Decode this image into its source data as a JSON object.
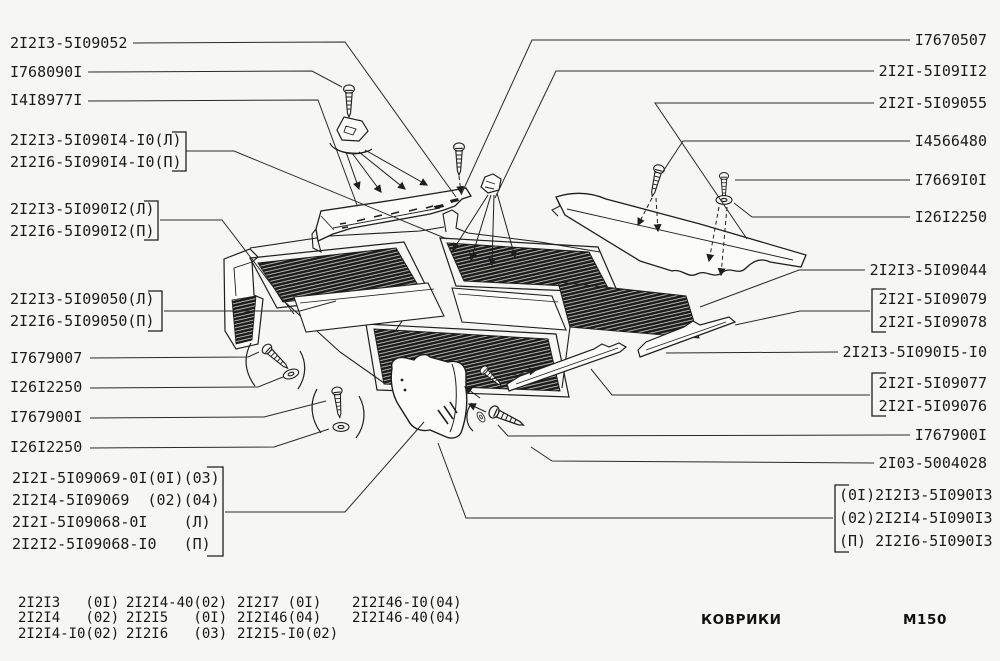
{
  "page": {
    "caption": "КОВРИКИ",
    "page_code": "М150",
    "background": "#f6f6f4",
    "ink": "#1e1e1e"
  },
  "labels": {
    "left": [
      {
        "text": "2I2I3-5I09052"
      },
      {
        "text": "I768090I"
      },
      {
        "text": "I4I8977I"
      },
      {
        "text": "2I2I3-5I090I4-I0(Л)"
      },
      {
        "text": "2I2I6-5I090I4-I0(П)"
      },
      {
        "text": "2I2I3-5I090I2(Л)"
      },
      {
        "text": "2I2I6-5I090I2(П)"
      },
      {
        "text": "2I2I3-5I09050(Л)"
      },
      {
        "text": "2I2I6-5I09050(П)"
      },
      {
        "text": "I7679007"
      },
      {
        "text": "I26I2250"
      },
      {
        "text": "I767900I"
      },
      {
        "text": "I26I2250"
      },
      {
        "text": "2I2I-5I09069-0I(0I)(03)"
      },
      {
        "text": "2I2I4-5I09069  (02)(04)"
      },
      {
        "text": "2I2I-5I09068-0I    (Л)"
      },
      {
        "text": "2I2I2-5I09068-I0   (П)"
      }
    ],
    "right": [
      {
        "text": "I7670507"
      },
      {
        "text": "2I2I-5I09II2"
      },
      {
        "text": "2I2I-5I09055"
      },
      {
        "text": "I4566480"
      },
      {
        "text": "I7669I0I"
      },
      {
        "text": "I26I2250"
      },
      {
        "text": "2I2I3-5I09044"
      },
      {
        "text": "2I2I-5I09079"
      },
      {
        "text": "2I2I-5I09078"
      },
      {
        "text": "2I2I3-5I090I5-I0"
      },
      {
        "text": "2I2I-5I09077"
      },
      {
        "text": "2I2I-5I09076"
      },
      {
        "text": "I767900I"
      },
      {
        "text": "2I03-5004028"
      },
      {
        "text": "(0I)2I2I3-5I090I3"
      },
      {
        "text": "(02)2I2I4-5I090I3"
      },
      {
        "text": "(П) 2I2I6-5I090I3"
      }
    ]
  },
  "legend": {
    "columns": [
      {
        "text": "2I2I3   (0I)\n2I2I4   (02)\n2I2I4-I0(02)"
      },
      {
        "text": "2I2I4-40(02)\n2I2I5   (0I)\n2I2I6   (03)"
      },
      {
        "text": "2I2I7 (0I)\n2I2I46(04)\n2I2I5-I0(02)"
      },
      {
        "text": "2I2I46-I0(04)\n2I2I46-40(04)"
      }
    ]
  }
}
